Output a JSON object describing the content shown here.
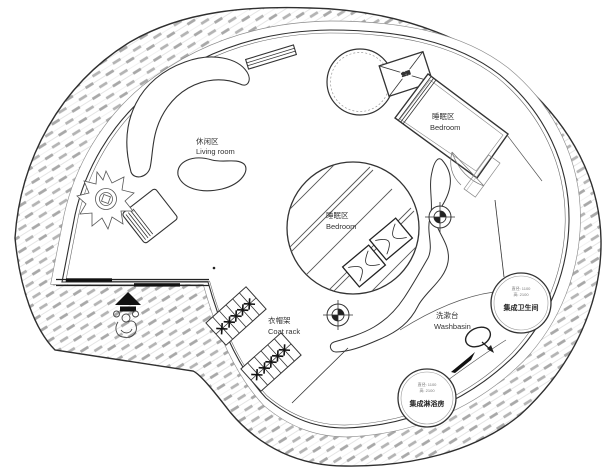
{
  "plan": {
    "labels": {
      "living": {
        "zh": "休闲区",
        "en": "Living room"
      },
      "bedroom_bed": {
        "zh": "睡眠区",
        "en": "Bedroom"
      },
      "bedroom_center": {
        "zh": "睡眠区",
        "en": "Bedroom"
      },
      "coat_rack": {
        "zh": "衣帽架",
        "en": "Coat rack"
      },
      "washbasin": {
        "zh": "洗漱台",
        "en": "Washbasin"
      }
    },
    "pods": {
      "bathroom": {
        "name": "集成卫生间",
        "dim1": "直径: 1100",
        "dim2": "高: 2100"
      },
      "shower": {
        "name": "集成淋浴房",
        "dim1": "直径: 1100",
        "dim2": "高: 2100"
      }
    },
    "equipment": {
      "ac_unit": "空调"
    },
    "colors": {
      "line": "#2f2f2f",
      "hatch_dash": "#a8a8a8",
      "hatch_line": "#dcdcdc",
      "text": "#333333",
      "background": "#ffffff"
    }
  }
}
